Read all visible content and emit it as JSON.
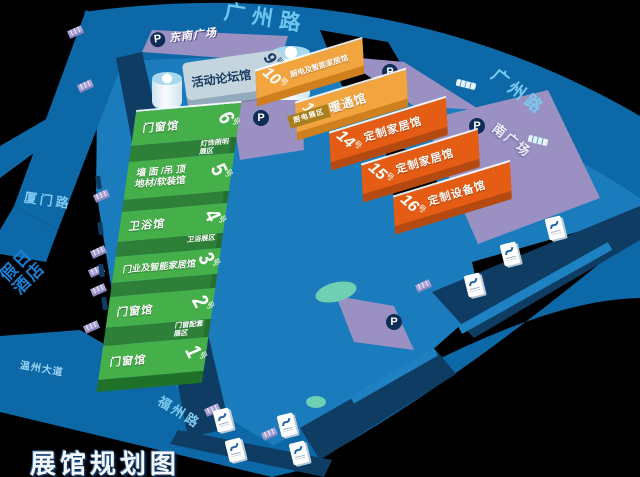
{
  "title": "展馆规划图",
  "hall_suffix": "号",
  "roads": {
    "guangzhou": "广州路",
    "xiamen": "厦门路",
    "wenzhou_avenue": "温州大道",
    "fuzhou": "福州路"
  },
  "places": {
    "southeast_plaza": "东南广场",
    "south_plaza": "南广场",
    "holiday_hotel_line1": "假日",
    "holiday_hotel_line2": "酒店",
    "parking": "P"
  },
  "forum_hall": {
    "name": "活动论坛馆",
    "num": "9"
  },
  "green_halls": [
    {
      "num": "6",
      "name": "门窗馆",
      "zone": "灯饰照明展区"
    },
    {
      "num": "5",
      "name_line1": "墙 面 /吊 顶",
      "name_line2": "地材/软装馆"
    },
    {
      "num": "4",
      "name": "卫浴馆",
      "zone": "卫浴展区"
    },
    {
      "num": "3",
      "name": "门业及智能家居馆"
    },
    {
      "num": "2",
      "name": "门窗馆",
      "zone": "门窗配套展区"
    },
    {
      "num": "1",
      "name": "门窗馆"
    }
  ],
  "orange_halls": [
    {
      "num": "10",
      "name": "厨电及智能家居馆"
    },
    {
      "num": "11",
      "name": "暖通馆",
      "zone": "厨电展区"
    },
    {
      "num": "14",
      "name": "定制家居馆"
    },
    {
      "num": "15",
      "name": "定制家居馆"
    },
    {
      "num": "16",
      "name": "定制设备馆"
    }
  ],
  "colors": {
    "ground": "#1a7cbd",
    "road": "#0c68a7",
    "dark_strip": "#0e3c63",
    "green_hall": "#45b04a",
    "green_dark": "#2e8038",
    "orange_light": "#f2a43e",
    "orange_dark": "#e55c15",
    "purple": "#9a90c2",
    "lavender_tag": "#aaa4d6",
    "teal": "#6fcfb2",
    "road_text": "#6ec6ee",
    "navy": "#0d2d56",
    "title_color": "#f4f8fc"
  }
}
